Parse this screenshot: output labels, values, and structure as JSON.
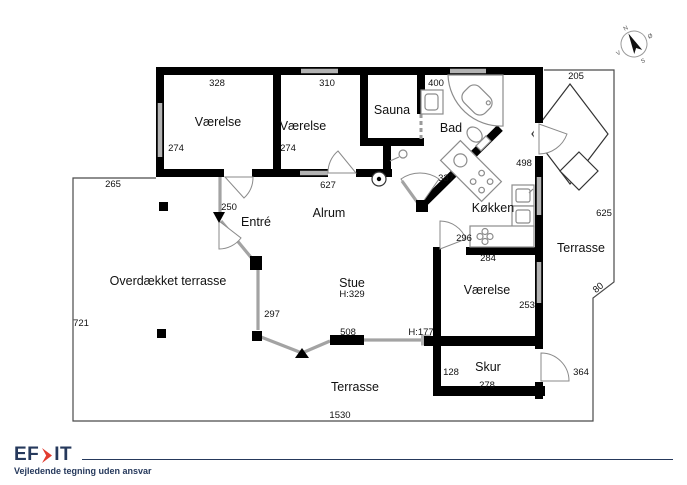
{
  "rooms": {
    "vaerelse1": "Værelse",
    "vaerelse2": "Værelse",
    "sauna": "Sauna",
    "bad": "Bad",
    "koekken": "Køkken",
    "alrum": "Alrum",
    "entre": "Entré",
    "overdaekket_terrasse": "Overdækket terrasse",
    "stue": "Stue",
    "stue_height": "H:329",
    "terrasse_east": "Terrasse",
    "vaerelse3": "Værelse",
    "skur": "Skur",
    "terrasse_south": "Terrasse"
  },
  "dims": {
    "d328": "328",
    "d310": "310",
    "d400": "400",
    "d205": "205",
    "d274a": "274",
    "d274b": "274",
    "d627": "627",
    "d337": "337",
    "d498": "498",
    "d265": "265",
    "d250": "250",
    "d296": "296",
    "d284": "284",
    "d253": "253",
    "d297": "297",
    "d508": "508",
    "h177": "H:177",
    "d128": "128",
    "d278": "278",
    "d364": "364",
    "d80": "80",
    "d625": "625",
    "d721": "721",
    "d1530": "1530"
  },
  "compass": {
    "n": "N",
    "oe": "Ø",
    "s": "S",
    "v": "V"
  },
  "footer": {
    "logo_left": "EF",
    "logo_right": "IT",
    "disclaimer": "Vejledende tegning uden ansvar"
  },
  "colors": {
    "wall": "#000000",
    "window": "#b3b3b3",
    "glass": "#a3a3a3",
    "boundary": "#4a4a4a",
    "fixture": "#8c8c8c",
    "furn": "#333333",
    "navy": "#26395c",
    "red": "#e23b2e",
    "text": "#111111"
  }
}
